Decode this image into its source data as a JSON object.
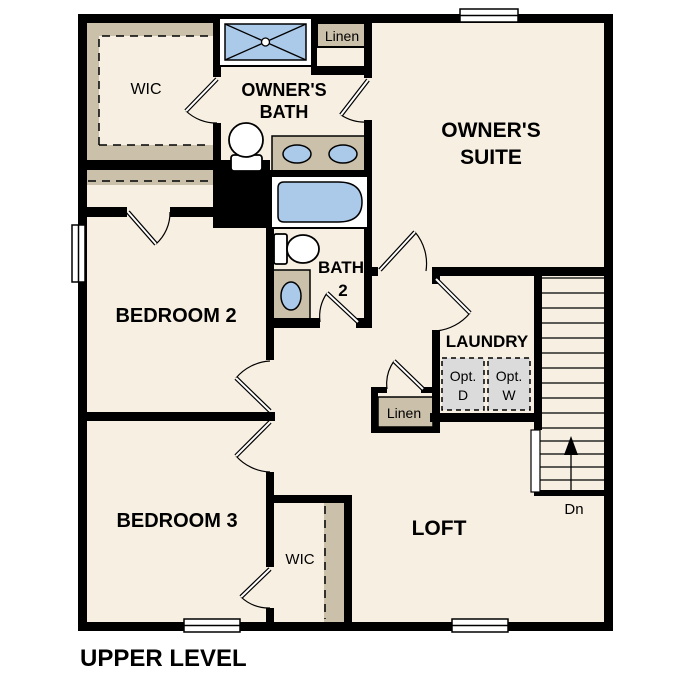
{
  "title": "UPPER LEVEL",
  "rooms": {
    "owners_suite": {
      "line1": "OWNER'S",
      "line2": "SUITE"
    },
    "owners_bath": {
      "line1": "OWNER'S",
      "line2": "BATH"
    },
    "owners_wic": "WIC",
    "bedroom2": "BEDROOM 2",
    "bath2": {
      "line1": "BATH",
      "line2": "2"
    },
    "laundry": "LAUNDRY",
    "linen_upper": "Linen",
    "linen_lower": "Linen",
    "bedroom3": "BEDROOM 3",
    "bedroom3_wic": "WIC",
    "loft": "LOFT"
  },
  "appliances": {
    "optional_dryer": {
      "line1": "Opt.",
      "line2": "D"
    },
    "optional_washer": {
      "line1": "Opt.",
      "line2": "W"
    }
  },
  "stairs": {
    "down_label": "Dn"
  },
  "colors": {
    "wall": "#000000",
    "floor": "#F7EFE2",
    "casework_tan": "#CBC0A9",
    "fixture_blue": "#ABC9E9",
    "appliance_gray": "#DBDBDB",
    "window_white": "#FFFFFF"
  }
}
